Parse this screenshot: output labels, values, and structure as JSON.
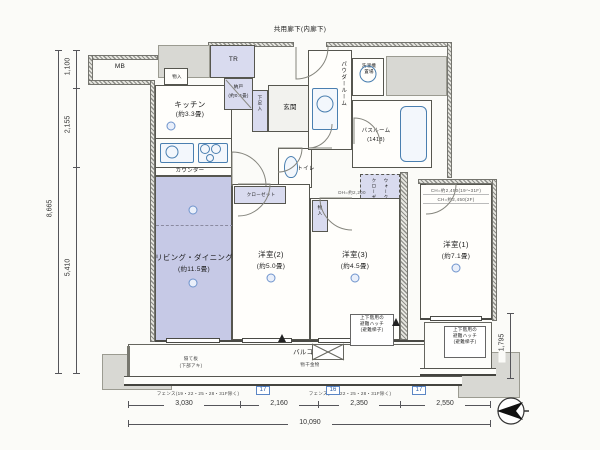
{
  "plan": {
    "corridor_top_label": "共用廊下(内廊下)",
    "rooms": {
      "kitchen": {
        "name": "キッチン",
        "size": "(約3.3畳)"
      },
      "counter": "カウンター",
      "living": {
        "name": "リビング・ダイニング",
        "size": "(約11.5畳)"
      },
      "bed2": {
        "name": "洋室(2)",
        "size": "(約5.0畳)"
      },
      "bed3": {
        "name": "洋室(3)",
        "size": "(約4.5畳)"
      },
      "bed1": {
        "name": "洋室(1)",
        "size": "(約7.1畳)"
      },
      "balcony": {
        "name": "バルコニー"
      },
      "genkan": "玄関",
      "hallway": "廊下",
      "toilet": "トイレ",
      "powder": "パウダールーム",
      "bath": "バスルーム",
      "bath_size": "(1418)",
      "laundry_line1": "洗濯機",
      "laundry_line2": "置場",
      "nando": "納戸",
      "nando_size": "(約0.4畳)",
      "tr": "TR",
      "mb": "MB",
      "shoe": "下足入",
      "closet": "クローゼット",
      "monoire": "物入",
      "wic_line1": "ウォークイン",
      "wic_line2": "クローゼット"
    },
    "notes": {
      "monohoshi": "物干金物",
      "hatch_line1": "上下階用の",
      "hatch_line2": "避難ハッチ",
      "hatch_line3": "(避難梯子)",
      "partition_line1": "隔て板",
      "partition_line2": "(下部アキ)",
      "fence": "フェンス(19・22・25・28・31F除く)",
      "ch1": "CH=約2,450(19〜31F)",
      "ch2": "CH=約2,450(2F)",
      "dh": "DH=約2,200"
    },
    "dims": {
      "left": [
        "1,100",
        "2,155",
        "5,410"
      ],
      "left_total": "8,665",
      "right": "1,795",
      "bottom": [
        "3,030",
        "2,160",
        "2,350",
        "2,550"
      ],
      "bottom_total": "10,090"
    },
    "markers": [
      "17",
      "16",
      "17"
    ],
    "colors": {
      "accent_lavender": "#c6c9e6",
      "fixture_blue": "#4a7fb0",
      "wall_gray": "#8f8f8a"
    }
  }
}
